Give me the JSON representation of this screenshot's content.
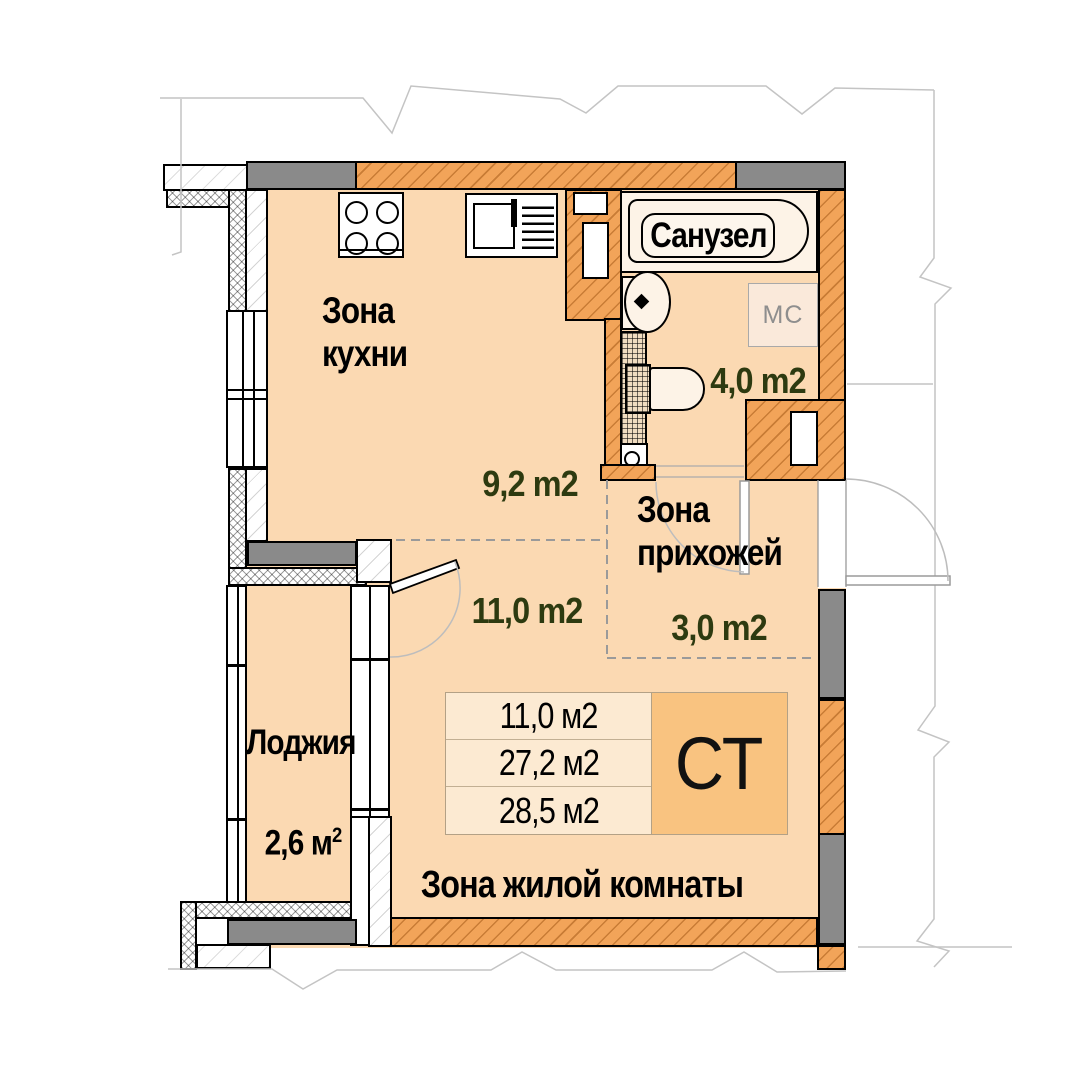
{
  "plan": {
    "type_code": "СТ",
    "zones": {
      "kitchen": {
        "label_line1": "Зона",
        "label_line2": "кухни",
        "area": "9,2 m2"
      },
      "room": {
        "area": "11,0 m2"
      },
      "hall": {
        "label_line1": "Зона",
        "label_line2": "прихожей",
        "area": "3,0 m2"
      },
      "bathroom": {
        "label": "Санузел",
        "area": "4,0 m2",
        "washing_machine": "МС"
      },
      "loggia": {
        "label": "Лоджия",
        "area_value": "2,6 м",
        "area_sup": "2"
      },
      "living": {
        "label": "Зона жилой комнаты"
      }
    },
    "summary_table": {
      "rows": [
        "11,0 м2",
        "27,2 м2",
        "28,5 м2"
      ],
      "type_code": "СТ"
    },
    "colors": {
      "floor": "#FBD9B2",
      "wall_orange": "#F2A459",
      "wall_gray": "#8A8A8A",
      "area_text": "#2D3A10",
      "type_cell": "#F9C380",
      "table_row": "#FCEAD2"
    }
  }
}
